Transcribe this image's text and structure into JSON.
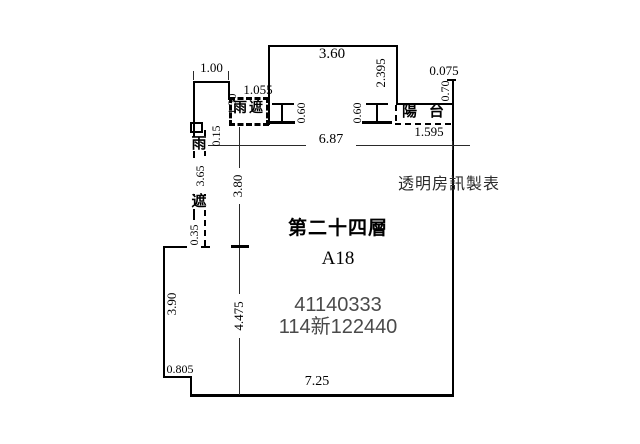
{
  "plan": {
    "floor_name": "第二十四層",
    "unit_id": "A18",
    "registration_no": "41140333",
    "case_no": "114新122440",
    "watermark": "透明房訊製表",
    "canopy_label": "雨遮",
    "canopy_char_top": "雨",
    "canopy_char_bottom": "遮",
    "balcony_label": "陽台"
  },
  "dims": {
    "top_left_width": "1.00",
    "canopy_width": "1.055",
    "top_left_height": "1.30",
    "small_offset": "0.15",
    "top_box_width": "3.60",
    "top_box_height": "2.395",
    "right_step": "0.075",
    "right_top_height": "0.70",
    "window_left": "0.60",
    "window_right": "0.60",
    "balcony_width": "1.595",
    "interior_width": "6.87",
    "upper_interior_height": "3.80",
    "canopy_strip_height": "3.65",
    "canopy_strip_width": "0.35",
    "left_wall_height": "3.90",
    "lower_interior_height": "4.475",
    "bottom_step_width": "0.805",
    "bottom_width": "7.25"
  },
  "colors": {
    "line": "#000000",
    "dimension_text": "#000000",
    "id_text": "#4a4a4a",
    "watermark_text": "#2b2b2b",
    "background": "#ffffff"
  }
}
